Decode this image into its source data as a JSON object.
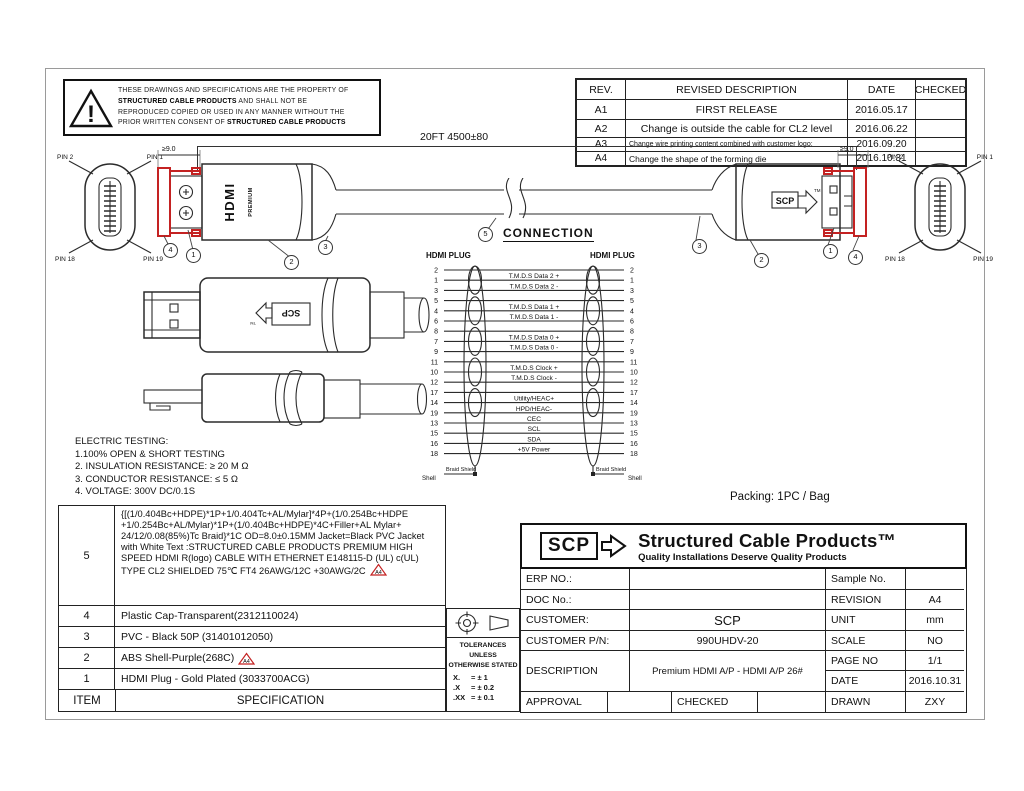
{
  "warning": {
    "lines": [
      [
        {
          "t": "THESE DRAWINGS AND SPECIFICATIONS ARE THE PROPERTY OF"
        }
      ],
      [
        {
          "t": "STRUCTURED CABLE PRODUCTS",
          "b": 1
        },
        {
          "t": "   AND SHALL NOT BE"
        }
      ],
      [
        {
          "t": "REPRODUCED COPIED OR USED IN ANY MANNER WITHOUT THE"
        }
      ],
      [
        {
          "t": "PRIOR WRITTEN CONSENT OF "
        },
        {
          "t": "STRUCTURED CABLE PRODUCTS",
          "b": 1
        }
      ]
    ]
  },
  "revision_table": {
    "headers": [
      "REV.",
      "REVISED  DESCRIPTION",
      "DATE",
      "CHECKED"
    ],
    "rows": [
      {
        "rev": "A1",
        "description": "FIRST RELEASE",
        "date": "2016.05.17",
        "checked": ""
      },
      {
        "rev": "A2",
        "description": "Change is outside the cable for CL2 level",
        "date": "2016.06.22",
        "checked": ""
      },
      {
        "rev": "A3",
        "description": "Change wire printing content combined with customer logo;",
        "date": "2016.09.20",
        "checked": ""
      },
      {
        "rev": "A4",
        "description": "Change the shape of the forming die",
        "date": "2016.10.31",
        "checked": ""
      }
    ]
  },
  "assembly": {
    "length_dim": "20FT 4500±80",
    "cap_dim": "≥9.0",
    "plug_brand": "HDMI",
    "plug_brand_sub": "PREMIUM",
    "scp_logo": "SCP",
    "scp_tm": "TM"
  },
  "face_labels": {
    "tl": "PIN 2",
    "tr": "PIN 1",
    "bl": "PIN 18",
    "br": "PIN 19"
  },
  "callouts": {
    "left": [
      "4",
      "1",
      "2",
      "3"
    ],
    "right": [
      "3",
      "2",
      "1",
      "4"
    ],
    "connection": "5"
  },
  "connection": {
    "title": "CONNECTION",
    "left_header": "HDMI PLUG",
    "right_header": "HDMI PLUG",
    "shell_label": "Shell",
    "braid_label": "Braid Shield",
    "rows": [
      {
        "pin": "2",
        "signal": "",
        "shield": true
      },
      {
        "pin": "1",
        "signal": "T.M.D.S   Data 2 +"
      },
      {
        "pin": "3",
        "signal": "T.M.D.S   Data 2 -"
      },
      {
        "pin": "5",
        "signal": "",
        "shield": true
      },
      {
        "pin": "4",
        "signal": "T.M.D.S   Data 1 +"
      },
      {
        "pin": "6",
        "signal": "T.M.D.S   Data 1 -"
      },
      {
        "pin": "8",
        "signal": "",
        "shield": true
      },
      {
        "pin": "7",
        "signal": "T.M.D.S   Data 0 +"
      },
      {
        "pin": "9",
        "signal": "T.M.D.S   Data 0 -"
      },
      {
        "pin": "11",
        "signal": "",
        "shield": true
      },
      {
        "pin": "10",
        "signal": "T.M.D.S   Clock +"
      },
      {
        "pin": "12",
        "signal": "T.M.D.S   Clock -"
      },
      {
        "pin": "17",
        "signal": "",
        "shield": true
      },
      {
        "pin": "14",
        "signal": "Utility/HEAC+"
      },
      {
        "pin": "19",
        "signal": "HPD/HEAC-"
      },
      {
        "pin": "13",
        "signal": "CEC"
      },
      {
        "pin": "15",
        "signal": "SCL"
      },
      {
        "pin": "16",
        "signal": "SDA"
      },
      {
        "pin": "18",
        "signal": "+5V Power"
      }
    ]
  },
  "electric_testing": {
    "title": "ELECTRIC TESTING:",
    "items": [
      "1.100% OPEN & SHORT TESTING",
      "2. INSULATION RESISTANCE: ≥ 20 M Ω",
      "3. CONDUCTOR RESISTANCE: ≤ 5 Ω",
      "4. VOLTAGE: 300V DC/0.1S"
    ]
  },
  "packing": "Packing: 1PC /  Bag",
  "spec_table": {
    "item_header": "ITEM",
    "spec_header": "SPECIFICATION",
    "marker_text": "A4",
    "rows": [
      {
        "item": "5",
        "spec": "{[(1/0.404Bc+HDPE)*1P+1/0.404Tc+AL/Mylar]*4P+(1/0.254Bc+HDPE +1/0.254Bc+AL/Mylar)*1P+(1/0.404Bc+HDPE)*4C+Filler+AL Mylar+ 24/12/0.08(85%)Tc Braid}*1C OD=8.0±0.15MM Jacket=Black  PVC Jacket with White Text  :STRUCTURED CABLE PRODUCTS PREMIUM HIGH SPEED HDMI R(logo) CABLE WITH ETHERNET E148115-D (UL) c(UL) TYPE CL2 SHIELDED 75℃ FT4 26AWG/12C +30AWG/2C",
        "marker": true
      },
      {
        "item": "4",
        "spec": "Plastic  Cap-Transparent(2312110024)"
      },
      {
        "item": "3",
        "spec": "PVC - Black 50P (31401012050)"
      },
      {
        "item": "2",
        "spec": "ABS Shell-Purple(268C)",
        "marker": true
      },
      {
        "item": "1",
        "spec": "HDMI Plug - Gold Plated (3033700ACG)"
      }
    ]
  },
  "tolerances": {
    "line1": "TOLERANCES UNLESS",
    "line2": "OTHERWISE STATED",
    "rows": [
      {
        "label": "X.",
        "value": "=  ±  1"
      },
      {
        "label": ".X",
        "value": "=  ±  0.2"
      },
      {
        "label": ".XX",
        "value": "=  ±  0.1"
      }
    ]
  },
  "title_block": {
    "logo_text": "SCP",
    "company": "Structured Cable Products™",
    "tagline": "Quality Installations Deserve Quality Products",
    "erp_label": "ERP  NO.:",
    "erp_value": "",
    "sample_label": "Sample No.",
    "sample_value": "",
    "doc_label": "DOC No.:",
    "doc_value": "",
    "revision_label": "REVISION",
    "revision_value": "A4",
    "customer_label": "CUSTOMER:",
    "customer_value": "SCP",
    "unit_label": "UNIT",
    "unit_value": "mm",
    "pn_label": "CUSTOMER P/N:",
    "pn_value": "990UHDV-20",
    "scale_label": "SCALE",
    "scale_value": "NO",
    "description_label": "DESCRIPTION",
    "description_value": "Premium  HDMI  A/P - HDMI A/P 26#",
    "page_label": "PAGE NO",
    "page_value": "1/1",
    "date_label": "DATE",
    "date_value": "2016.10.31",
    "approval_label": "APPROVAL",
    "checked_label": "CHECKED",
    "drawn_label": "DRAWN",
    "drawn_value": "ZXY"
  },
  "colors": {
    "accent_red": "#c42222",
    "line": "#2b2b2b"
  }
}
